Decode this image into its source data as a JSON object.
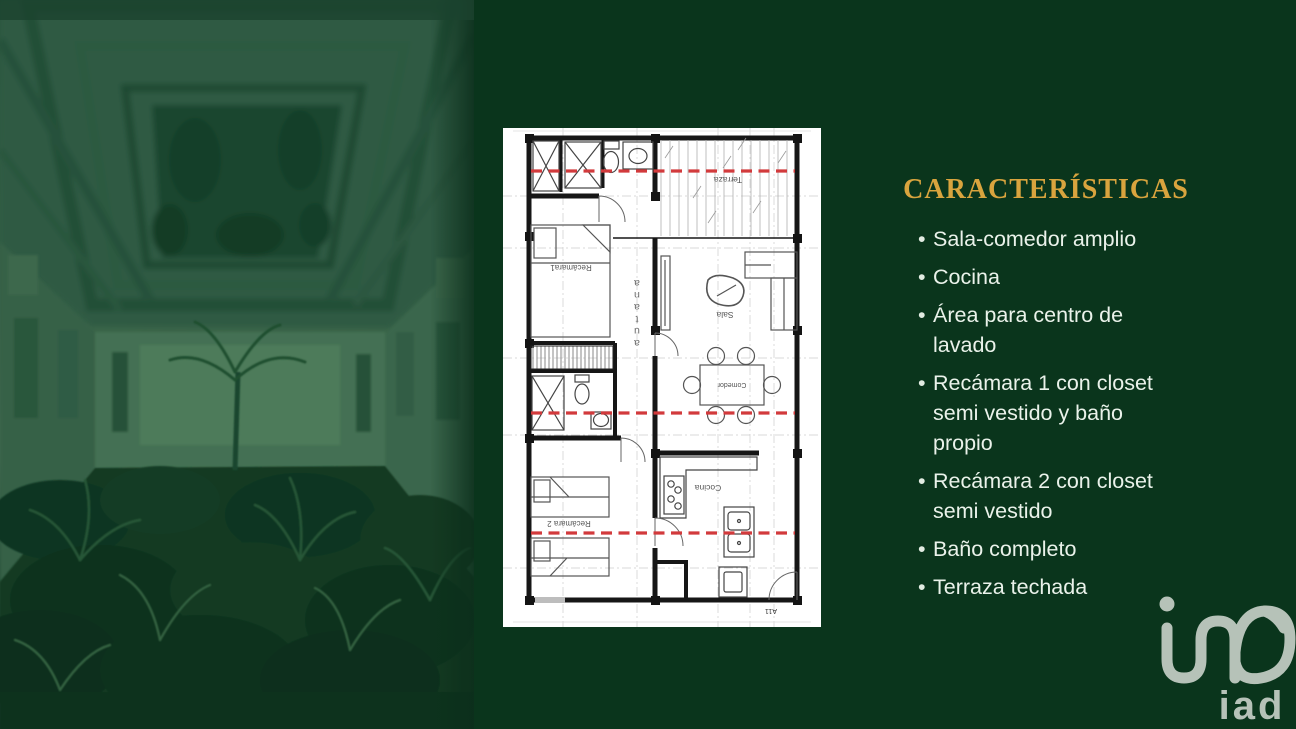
{
  "slide": {
    "background_color": "#0a351c",
    "accent_color": "#d9a43e",
    "text_color": "#eaf2ea",
    "bullet_char": "•"
  },
  "features_panel": {
    "title": "CARACTERÍSTICAS",
    "bullets": [
      "Sala-comedor amplio",
      "Cocina",
      "Área para centro de lavado",
      "Recámara 1 con closet semi vestido y baño propio",
      "Recámara 2 con closet semi vestido",
      "Baño completo",
      "Terraza techada"
    ]
  },
  "floor_plan": {
    "labels": {
      "terraza": "Terraza",
      "sala": "Sala",
      "comedor": "Comedor",
      "cocina": "Cocina",
      "recamara1": "Recámara1",
      "recamara2": "Recámara 2",
      "sheet_code": "A11"
    },
    "watermark_letters": [
      "a",
      "u",
      "t",
      "a",
      "n",
      "a"
    ],
    "red_line_color": "#d23a3c"
  },
  "logo": {
    "text": "iad",
    "color": "#b6c2b8"
  }
}
